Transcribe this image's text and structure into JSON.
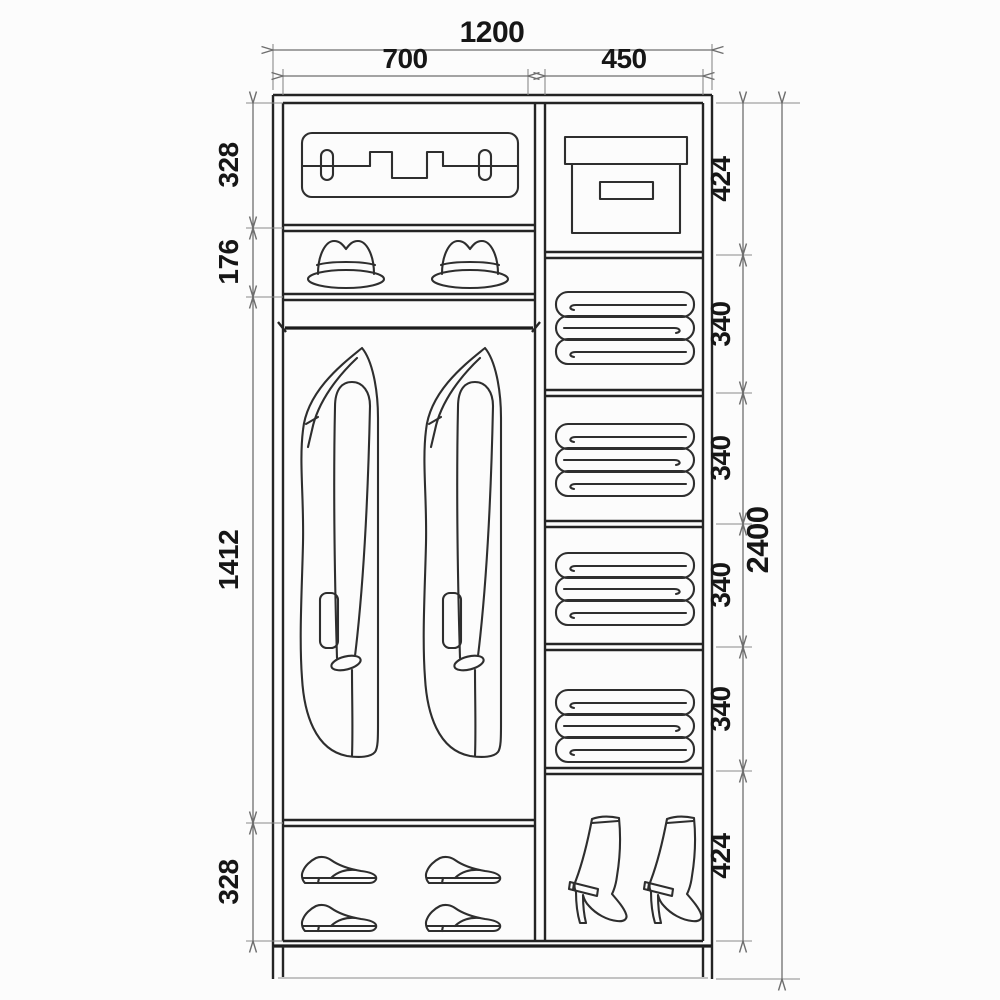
{
  "drawing": {
    "kind": "wardrobe-interior-dimension-diagram",
    "description": "Front-view technical drawing of a two-door wardrobe interior with dimension lines",
    "colors": {
      "background": "#fcfcfc",
      "structure_line": "#242424",
      "icon_line": "#2e2e2e",
      "dimension_line": "#6e6e6e",
      "label_text": "#161616"
    }
  },
  "dims": {
    "width_total": "1200",
    "width_left": "700",
    "width_right": "450",
    "height_total": "2400",
    "left": [
      {
        "label": "328"
      },
      {
        "label": "176"
      },
      {
        "label": "1412"
      },
      {
        "label": "328"
      }
    ],
    "right": [
      {
        "label": "424"
      },
      {
        "label": "340"
      },
      {
        "label": "340"
      },
      {
        "label": "340"
      },
      {
        "label": "340"
      },
      {
        "label": "424"
      }
    ]
  },
  "compartments": {
    "left_column": [
      {
        "content": "suitcase",
        "height": "328"
      },
      {
        "content": "hats",
        "height": "176"
      },
      {
        "content": "hanging-rail-with-coats",
        "height": "1412"
      },
      {
        "content": "shoes",
        "height": "328"
      }
    ],
    "right_column": [
      {
        "content": "storage-box",
        "height": "424"
      },
      {
        "content": "folded-linen",
        "height": "340"
      },
      {
        "content": "folded-linen",
        "height": "340"
      },
      {
        "content": "folded-linen",
        "height": "340"
      },
      {
        "content": "folded-linen",
        "height": "340"
      },
      {
        "content": "boots",
        "height": "424"
      }
    ]
  },
  "icons": {
    "suitcase": "suitcase-icon",
    "hat": "hat-icon",
    "rail": "hanging-rail-icon",
    "coat": "coat-icon",
    "shoe": "shoe-icon",
    "box": "storage-box-icon",
    "linen": "folded-linen-icon",
    "boot": "boot-icon"
  }
}
